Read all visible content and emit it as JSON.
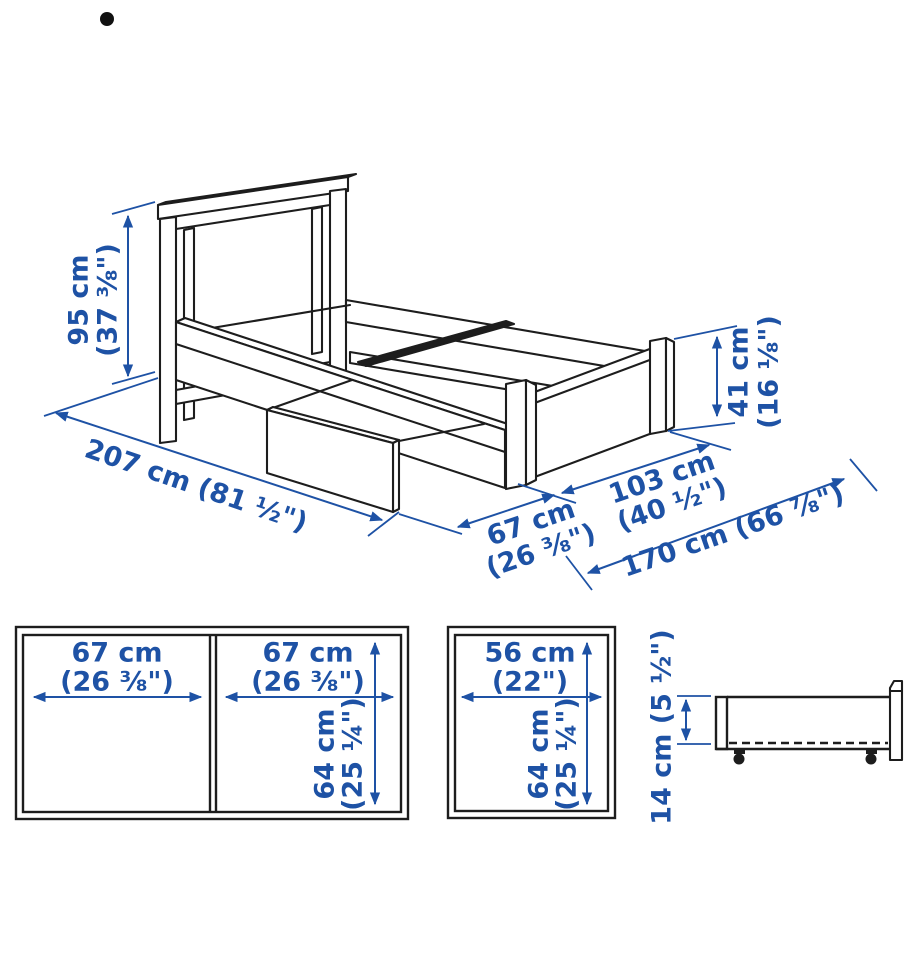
{
  "colors": {
    "dimension_blue": "#1e52a5",
    "line_black": "#1d1d1d"
  },
  "bullet": "•",
  "bed_view": {
    "headboard_height": {
      "metric": "95 cm",
      "imperial": "(37 ⅜\")"
    },
    "footboard_height": {
      "metric": "41 cm",
      "imperial": "(16 ⅛\")"
    },
    "length": {
      "combined": "207 cm (81 ½\")"
    },
    "drawer_extension": {
      "metric": "67 cm",
      "imperial": "(26 ⅜\")"
    },
    "width": {
      "metric": "103 cm",
      "imperial": "(40 ½\")"
    },
    "total_width_drawer_open": {
      "combined": "170 cm (66 ⅞\")"
    }
  },
  "double_drawer_top_view": {
    "left_width": {
      "metric": "67 cm",
      "imperial": "(26 ⅜\")"
    },
    "right_width": {
      "metric": "67 cm",
      "imperial": "(26 ⅜\")"
    },
    "depth": {
      "metric": "64 cm",
      "imperial": "(25 ¼\")"
    }
  },
  "single_drawer_top_view": {
    "width": {
      "metric": "56 cm",
      "imperial": "(22\")"
    },
    "depth": {
      "metric": "64 cm",
      "imperial": "(25 ¼\")"
    }
  },
  "drawer_side_view": {
    "height": {
      "combined": "14 cm (5 ½\")"
    }
  }
}
